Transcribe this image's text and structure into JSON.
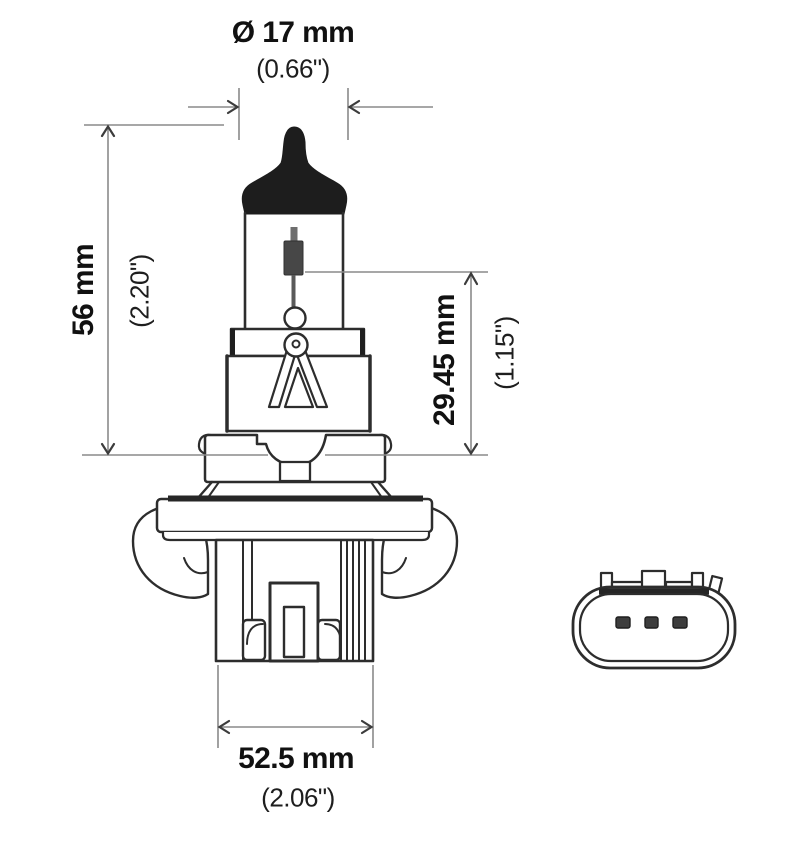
{
  "diagram": {
    "dimensions": {
      "diameter": {
        "metric": "Ø 17 mm",
        "imperial": "(0.66\")"
      },
      "overall_height": {
        "metric": "56 mm",
        "imperial": "(2.20\")"
      },
      "filament_to_base": {
        "metric": "29.45 mm",
        "imperial": "(1.15\")"
      },
      "base_width": {
        "metric": "52.5 mm",
        "imperial": "(2.06\")"
      }
    },
    "colors": {
      "background": "#ffffff",
      "outline": "#2d2d2d",
      "dimension_line": "#8a8a8a",
      "arrow": "#3c3c3c",
      "text": "#111111",
      "tip_fill": "#1d1d1d",
      "filament_fill": "#474747"
    }
  }
}
